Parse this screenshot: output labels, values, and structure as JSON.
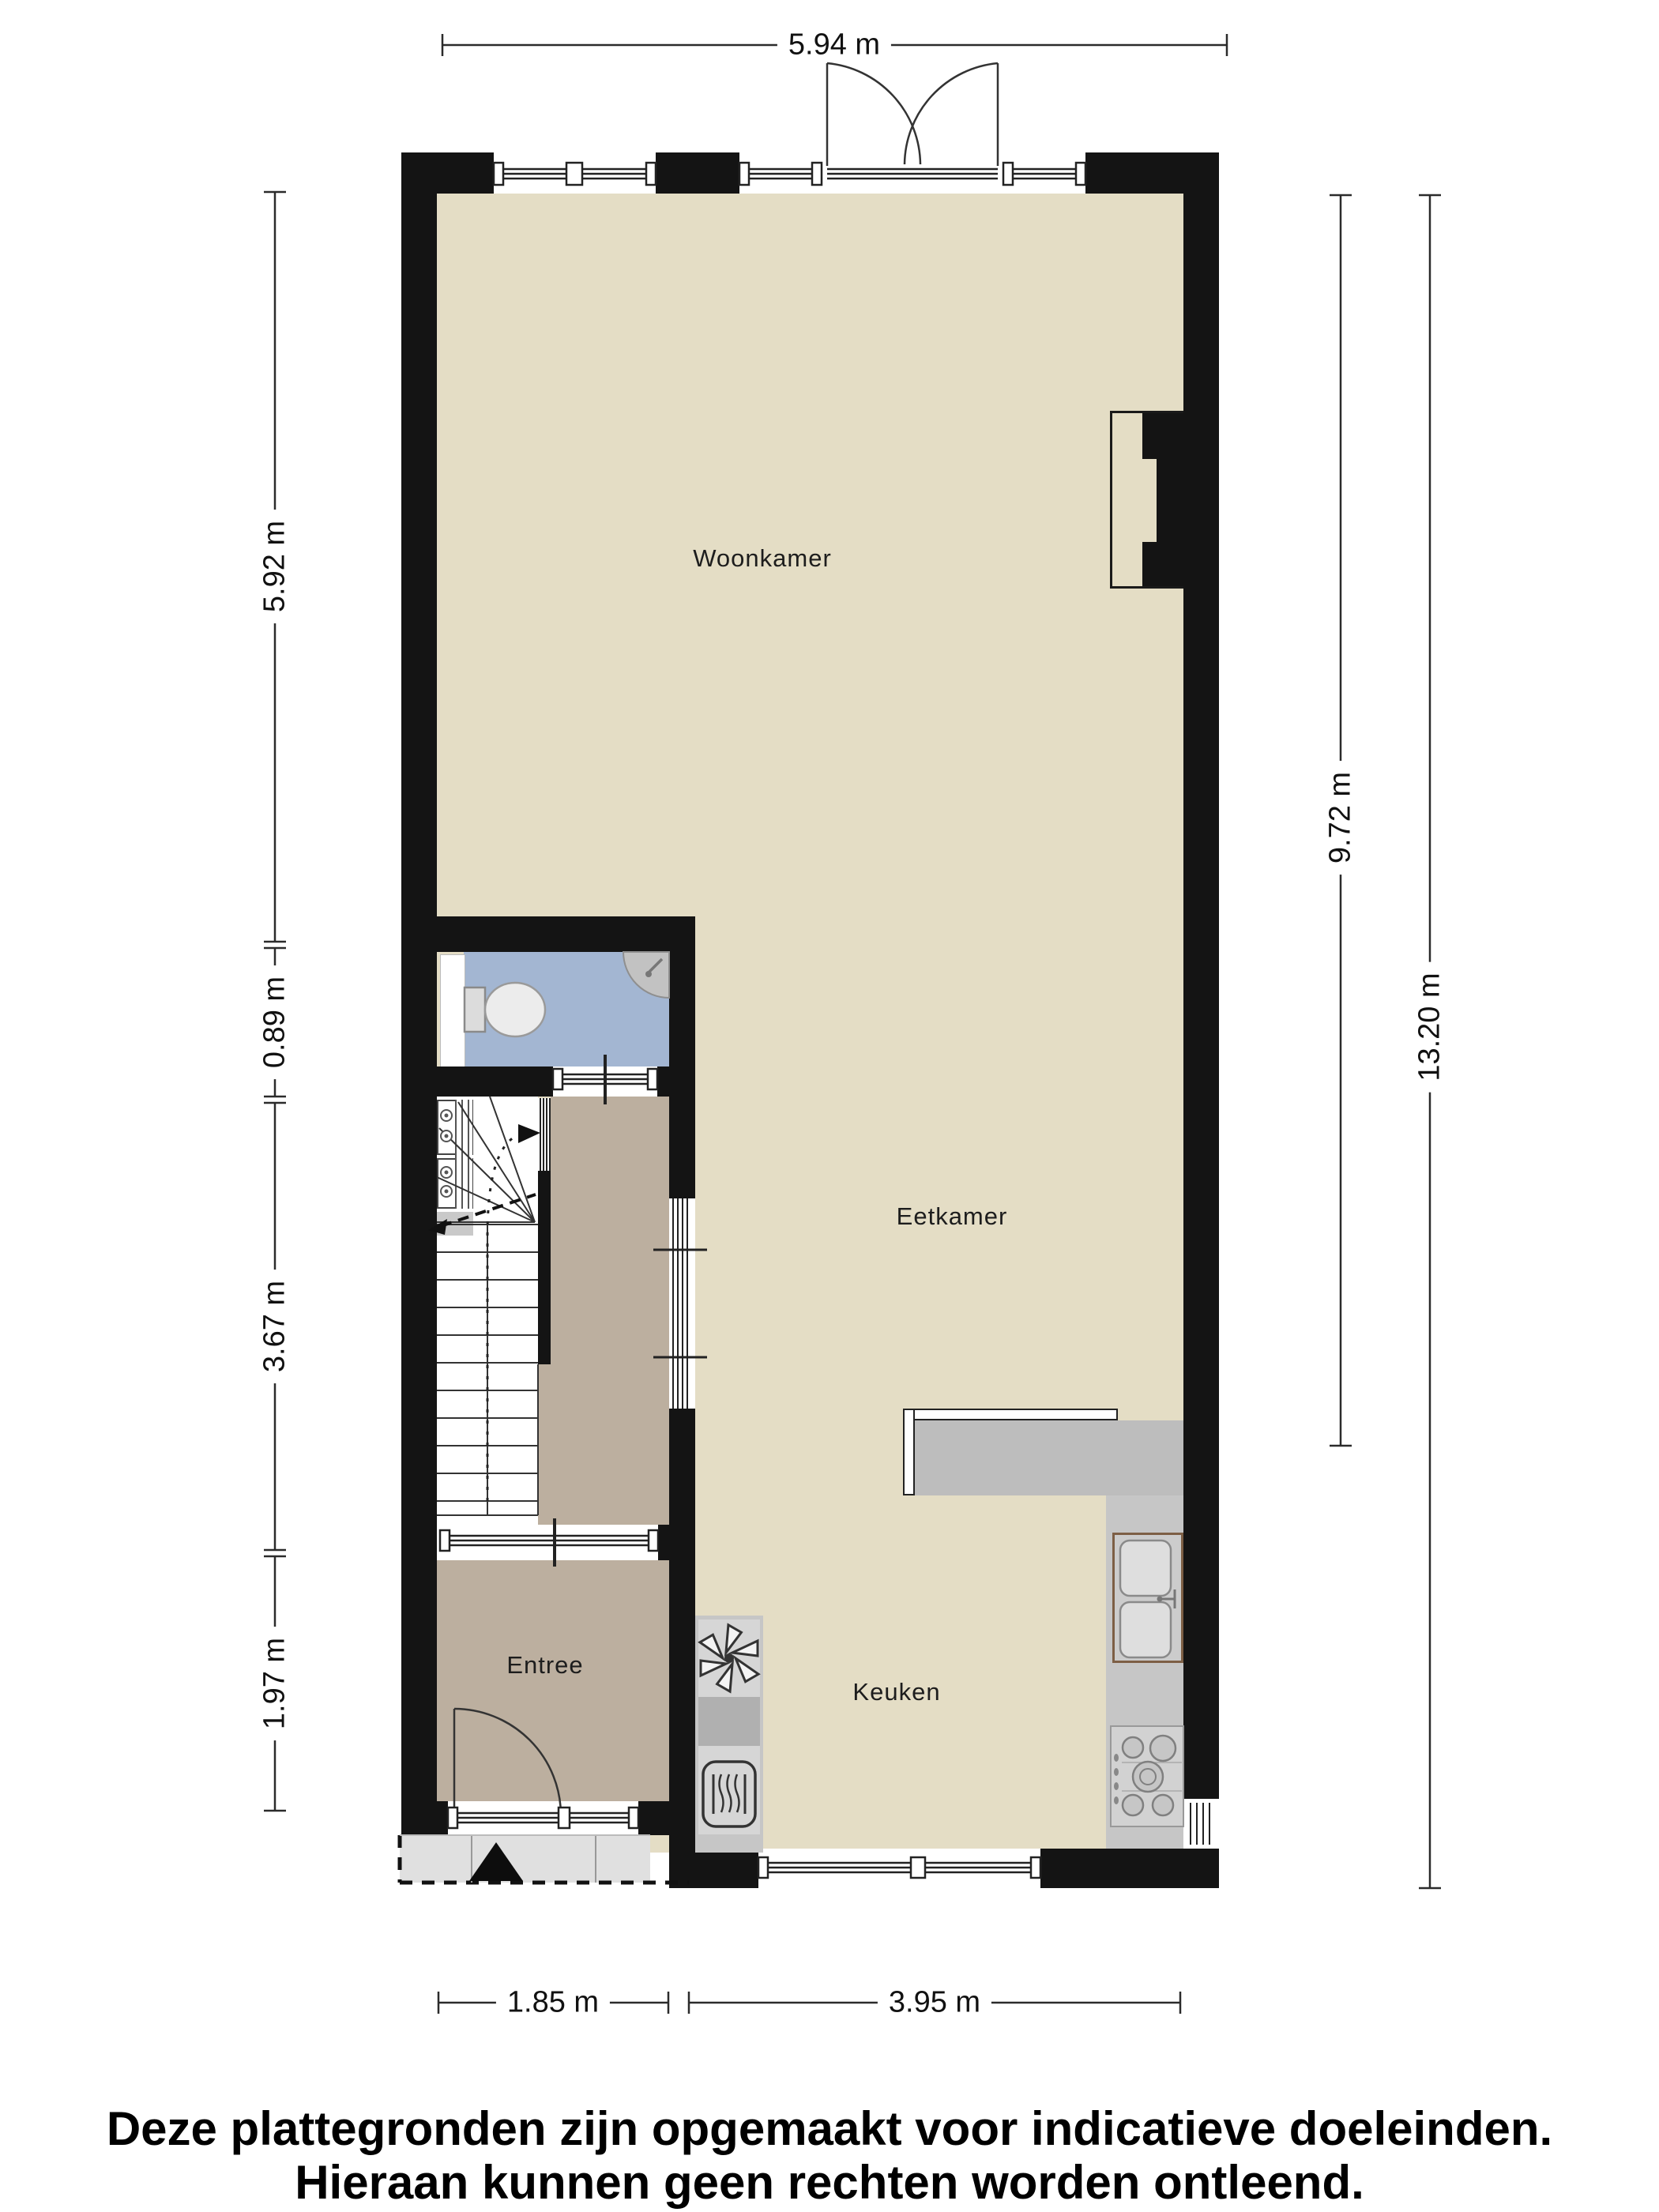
{
  "rooms": {
    "woonkamer": "Woonkamer",
    "eetkamer": "Eetkamer",
    "keuken": "Keuken",
    "entree": "Entree"
  },
  "dimensions": {
    "top": "5.94 m",
    "left": [
      "5.92 m",
      "0.89 m",
      "3.67 m",
      "1.97 m"
    ],
    "right_inner": "9.72 m",
    "right_outer": "13.20 m",
    "bottom": [
      "1.85 m",
      "3.95 m"
    ]
  },
  "disclaimer": {
    "line1": "Deze plattegronden zijn opgemaakt voor indicatieve doeleinden.",
    "line2": "Hieraan kunnen geen rechten worden ontleend."
  },
  "icons": {
    "toilet": "toilet-icon",
    "corner_sink": "corner-sink-icon",
    "extractor_fan": "extractor-fan-icon",
    "oven": "oven-icon",
    "kitchen_sink": "kitchen-sink-icon",
    "gas_hob": "gas-hob-icon",
    "stairs": "stairs-icon",
    "entrance_arrow": "entrance-arrow-icon",
    "meter_cupboard": "meter-cupboard-icon"
  },
  "colors": {
    "wall": "#141414",
    "floor_main": "#e4ddc5",
    "floor_hall": "#bcaf9f",
    "floor_toilet": "#a3b6d2",
    "porch": "#e0e0e0",
    "counter": "#c6c6c6",
    "sink_frame": "#7d5f45"
  }
}
